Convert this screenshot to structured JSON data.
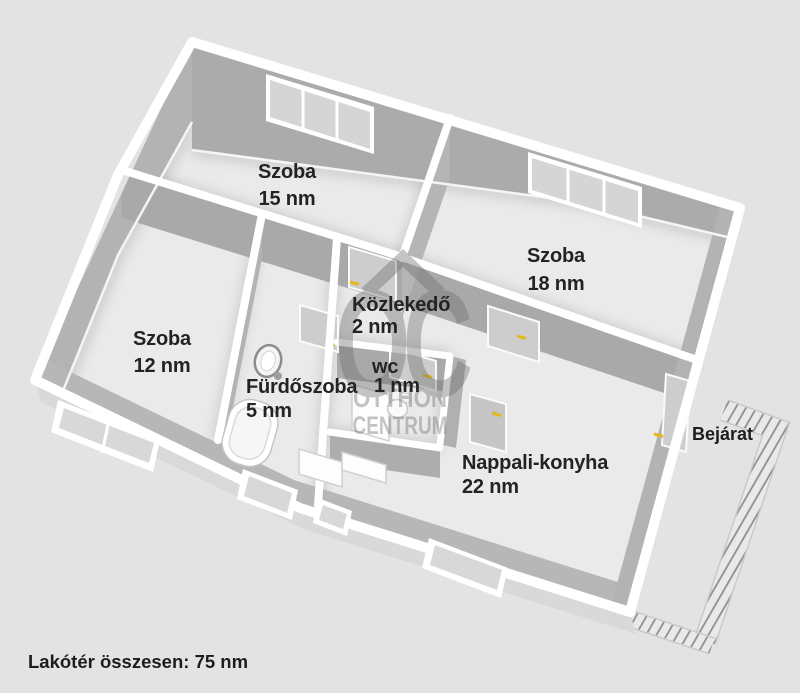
{
  "plan": {
    "rooms": [
      {
        "id": "szoba-15",
        "name": "Szoba",
        "area": "15 nm"
      },
      {
        "id": "szoba-18",
        "name": "Szoba",
        "area": "18 nm"
      },
      {
        "id": "szoba-12",
        "name": "Szoba",
        "area": "12 nm"
      },
      {
        "id": "kozlekedo",
        "name": "Közlekedő",
        "area": "2 nm"
      },
      {
        "id": "wc",
        "name": "wc",
        "area": "1 nm"
      },
      {
        "id": "furdoszoba",
        "name": "Fürdőszoba",
        "area": "5 nm"
      },
      {
        "id": "nappali-konyha",
        "name": "Nappali-konyha",
        "area": "22 nm"
      }
    ],
    "entrance_label": "Bejárat",
    "total_label": "Lakótér összesen: 75 nm"
  },
  "watermark": {
    "logo": "OC",
    "line1": "OTTHON",
    "line2": "CENTRUM"
  },
  "colors": {
    "background": "#e3e3e3",
    "floor": "#eaeaea",
    "wall_face": "#ababab",
    "wall_cap": "#ffffff",
    "window_glass": "#d5d5d5",
    "door_panel": "#cdcdcd",
    "door_handle": "#e3b71e",
    "hatch": "#8f8f8f",
    "watermark": "#6e6e6e",
    "label_text": "#232323"
  }
}
